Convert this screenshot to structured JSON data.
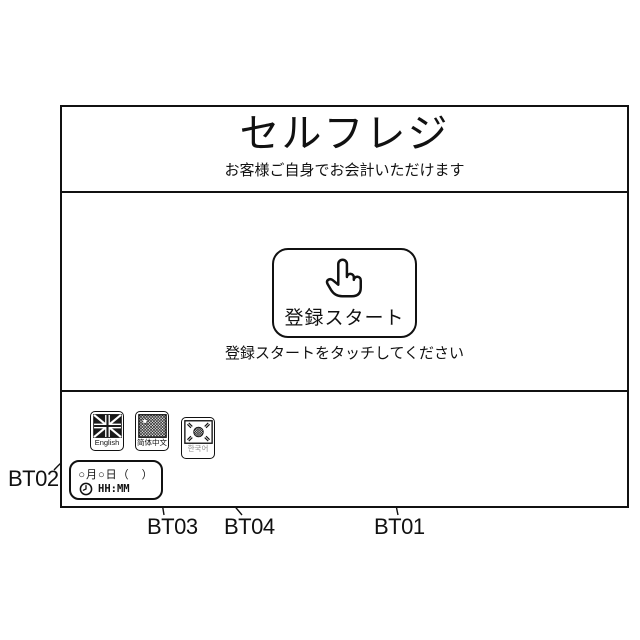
{
  "colors": {
    "ink": "#111111",
    "background": "#ffffff",
    "korean_label_gray": "#8a8a8a"
  },
  "screen": {
    "title": "セルフレジ",
    "subtitle": "お客様ご自身でお会計いただけます",
    "start_button": {
      "label": "登録スタート",
      "icon": "pointing-hand"
    },
    "instruction": "登録スタートをタッチしてください",
    "language_buttons": [
      {
        "label": "English",
        "flag": "united-kingdom"
      },
      {
        "label": "简体中文",
        "flag": "china"
      },
      {
        "label": "한국어",
        "flag": "south-korea"
      }
    ],
    "datetime": {
      "date_placeholder": "○月○日（　）",
      "time_placeholder": "HH:MM",
      "icon": "clock"
    }
  },
  "callouts": [
    {
      "id": "bt01",
      "label": "BT01",
      "target": "start-button"
    },
    {
      "id": "bt02",
      "label": "BT02",
      "target": "english-button"
    },
    {
      "id": "bt03",
      "label": "BT03",
      "target": "chinese-button"
    },
    {
      "id": "bt04",
      "label": "BT04",
      "target": "korean-button"
    }
  ]
}
